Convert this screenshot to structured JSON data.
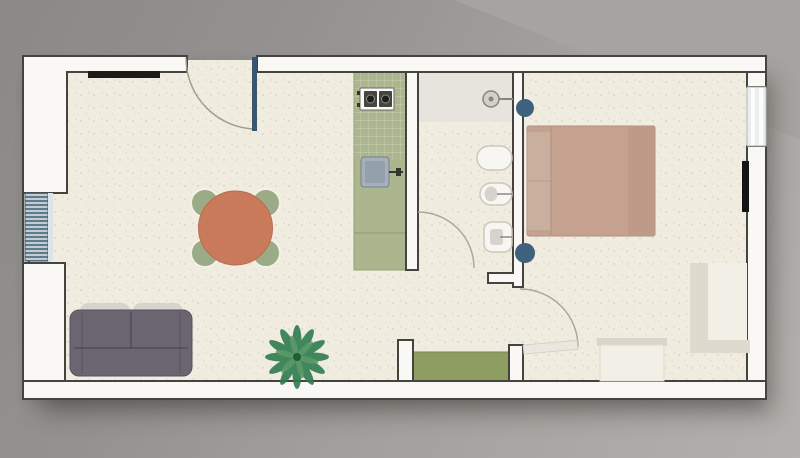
{
  "scene": "apartment-floor-plan",
  "rooms": [
    {
      "name": "living-room",
      "furniture": [
        "sofa",
        "sofa-back-cushions",
        "dining-table",
        "dining-chairs-x4",
        "potted-plant",
        "wall-cabinet",
        "radiator"
      ]
    },
    {
      "name": "kitchen",
      "furniture": [
        "counter",
        "cooktop-2-burners",
        "kitchen-sink",
        "faucet"
      ]
    },
    {
      "name": "bathroom",
      "furniture": [
        "shower-area",
        "shower-head",
        "washbasin",
        "bidet",
        "toilet"
      ]
    },
    {
      "name": "bedroom",
      "furniture": [
        "double-bed",
        "pillows",
        "nightstand-top",
        "nightstand-bottom",
        "desk",
        "dresser",
        "radiator",
        "window"
      ]
    },
    {
      "name": "hallway",
      "furniture": [
        "green-mat"
      ]
    }
  ],
  "doors": [
    {
      "name": "entrance-door",
      "state": "open",
      "leaf_color": "#3a566c"
    },
    {
      "name": "bathroom-door",
      "state": "open-arc"
    },
    {
      "name": "bedroom-door",
      "state": "open",
      "leaf_color": "#eae7de"
    }
  ],
  "counts": {
    "dining_chairs": 4,
    "nightstands": 2,
    "bathroom_fixtures": 3,
    "radiators": 2
  },
  "colors": {
    "background_dark": "#8b8986",
    "background_light": "#b3b0ad",
    "wall_fill": "#f9f8f4",
    "wall_outline": "#45433f",
    "floor": "#f0ecdf",
    "floor_speckle": "#ded7c3",
    "kitchen_counter": "#abb68e",
    "green_mat": "#8e9d62",
    "dining_table": "#c97a5b",
    "dining_chairs": "#9cab87",
    "sofa_body": "#6b6471",
    "sofa_cushions": "#d7d4cf",
    "bed_blanket": "#c5a290",
    "bed_pillows": "#cbaf9e",
    "nightstands": "#3e627d",
    "entrance_door_leaf": "#3a566c",
    "radiator_left_stripe": "#5d7b8d",
    "radiator_bedroom": "#141414",
    "wall_cabinet": "#1b1b19",
    "plant_dark": "#2f7b50",
    "plant_light": "#5d9a68",
    "fixture_fill": "#f8f6f2",
    "fixture_outline": "#ccc8bf",
    "kitchen_sink": "#a5b0bb",
    "shower_area": "#e7e4dd",
    "window_glass": "#eceeed",
    "light_furniture": "#f2efe7"
  }
}
